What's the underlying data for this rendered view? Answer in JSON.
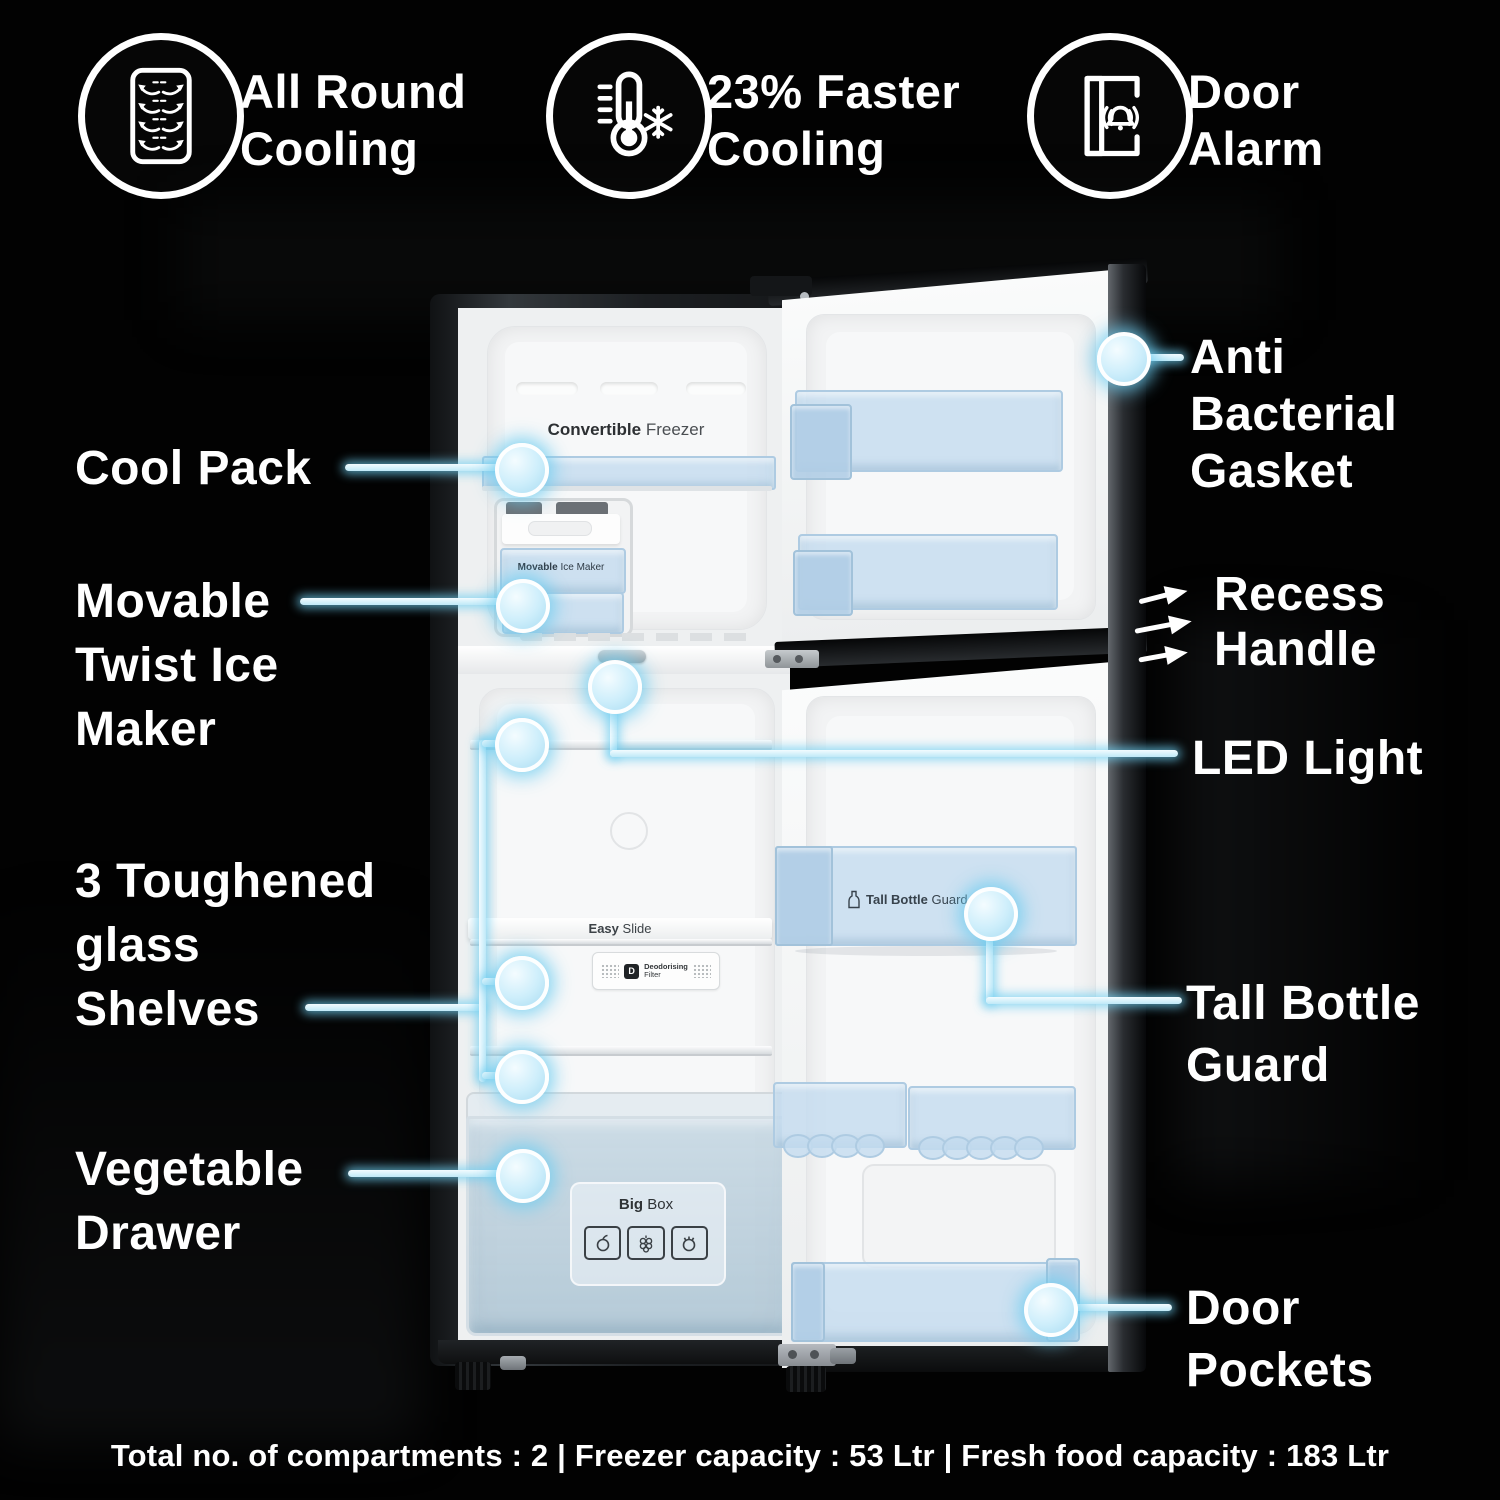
{
  "header_features": [
    {
      "icon": "all-round-cooling-icon",
      "label": "All Round\nCooling"
    },
    {
      "icon": "faster-cooling-icon",
      "label": "23% Faster\nCooling"
    },
    {
      "icon": "door-alarm-icon",
      "label": "Door\nAlarm"
    }
  ],
  "left_callouts": [
    {
      "label": "Cool Pack"
    },
    {
      "label": "Movable\nTwist Ice\nMaker"
    },
    {
      "label": "3 Toughened\nglass\nShelves"
    },
    {
      "label": "Vegetable\nDrawer"
    }
  ],
  "right_callouts": [
    {
      "label": "Anti\nBacterial\nGasket"
    },
    {
      "label": "Recess\nHandle"
    },
    {
      "label": "LED Light"
    },
    {
      "label": "Tall Bottle\nGuard"
    },
    {
      "label": "Door\nPockets"
    }
  ],
  "fridge": {
    "freezer_label": {
      "bold": "Convertible",
      "regular": "Freezer"
    },
    "ice_maker_label": {
      "bold": "Movable",
      "regular": "Ice Maker"
    },
    "shelf_label": {
      "bold": "Easy",
      "regular": "Slide"
    },
    "filter_label": {
      "line1": "Deodorising",
      "line2": "Filter"
    },
    "bottle_guard_label": {
      "bold": "Tall Bottle",
      "regular": "Guard"
    },
    "drawer_label": {
      "bold": "Big",
      "regular": "Box"
    }
  },
  "footer": {
    "specs": "Total no. of compartments : 2 | Freezer capacity : 53 Ltr | Fresh food capacity : 183 Ltr"
  },
  "colors": {
    "background": "#000000",
    "label_text": "#ffffff",
    "callout_accent": "#bfe9f8",
    "callout_glow": "#7fd0ee",
    "bin_blue": "#c5ddf0"
  }
}
